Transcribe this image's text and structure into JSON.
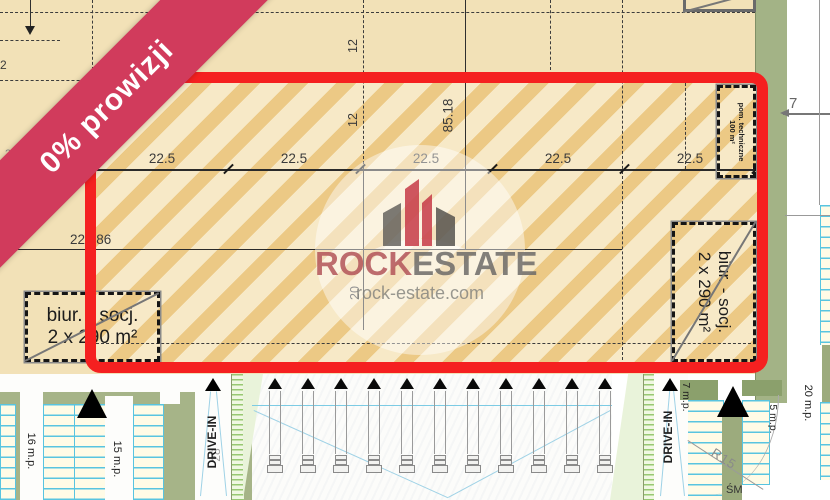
{
  "ribbon": {
    "label": "0% prowizji"
  },
  "watermark": {
    "brand_left": "ROCK",
    "brand_right": "ESTATE",
    "website": "rock-estate.com"
  },
  "dimensions": {
    "bays": [
      "22.5",
      "22.5",
      "22.5",
      "22.5",
      "22.5"
    ],
    "depth_total": "85.18",
    "bay_a": "12",
    "bay_b": "12",
    "bay_c": "20",
    "width_total": "222.86",
    "edge_left": "2",
    "edge_left_partial": "22",
    "offset_right": "7"
  },
  "rooms": {
    "office_left_line1": "biur. - socj.",
    "office_left_line2": "2 x 290 m²",
    "office_right_line1": "biur. - socj.",
    "office_right_line2": "2 x 290 m²",
    "tech_line1": "pom. techniczne",
    "tech_line2": "100 m²"
  },
  "site": {
    "parking_16": "16 m.p.",
    "parking_15": "15 m.p.",
    "drive_in_left": "DRIVE-IN",
    "drive_in_left_count": "28",
    "drive_in_right": "DRIVE-IN",
    "parking_7": "7 m.p.",
    "parking_5": "5 m.p.",
    "parking_20": "20 m.p.",
    "radius": "R15",
    "trash": "ŚM",
    "dock_lane_count": 11
  },
  "colors": {
    "accent_red": "#f52020",
    "ribbon": "#d13b5c",
    "hatch_dark": "#ecc985",
    "hatch_light": "#f7e9c7",
    "plan_tan": "#f2e1b7",
    "green": "#a6b488",
    "cyan": "#58c4e0"
  }
}
